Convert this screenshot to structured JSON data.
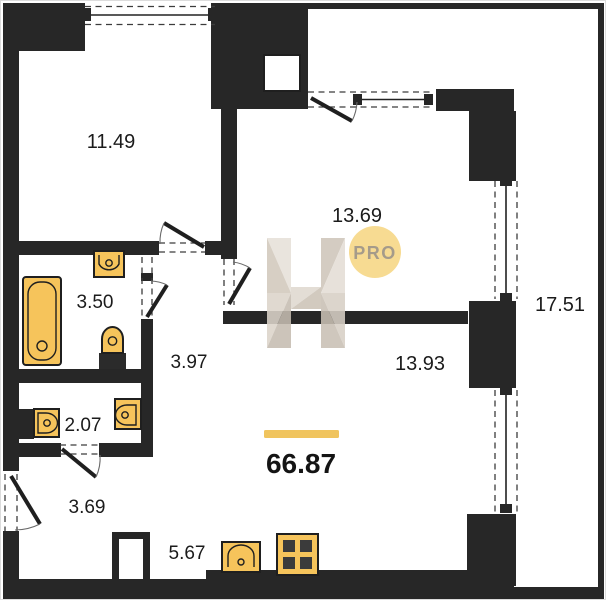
{
  "plan_title": "Apartment floor plan",
  "total_area": "66.87",
  "rooms": [
    {
      "key": "room-a",
      "area": "11.49"
    },
    {
      "key": "kitchen-living",
      "area": "13.69"
    },
    {
      "key": "terrace",
      "area": "17.51"
    },
    {
      "key": "bathroom",
      "area": "3.50"
    },
    {
      "key": "hallway",
      "area": "3.97"
    },
    {
      "key": "room-b",
      "area": "13.93"
    },
    {
      "key": "wc",
      "area": "2.07"
    },
    {
      "key": "entry-hall",
      "area": "3.69"
    },
    {
      "key": "kitchen",
      "area": "5.67"
    }
  ],
  "watermark": {
    "letter": "H",
    "badge_label": "PRO"
  },
  "colors": {
    "wall": "#272727",
    "fixture": "#F6C45B",
    "fixture_stroke": "#1F1F1F",
    "accent_bar": "#F0C45E",
    "badge_fill": "#F7DB92",
    "badge_text": "#A59B8A",
    "watermark_light": "#E7E1D9",
    "watermark_dark": "#C6BDB1"
  }
}
